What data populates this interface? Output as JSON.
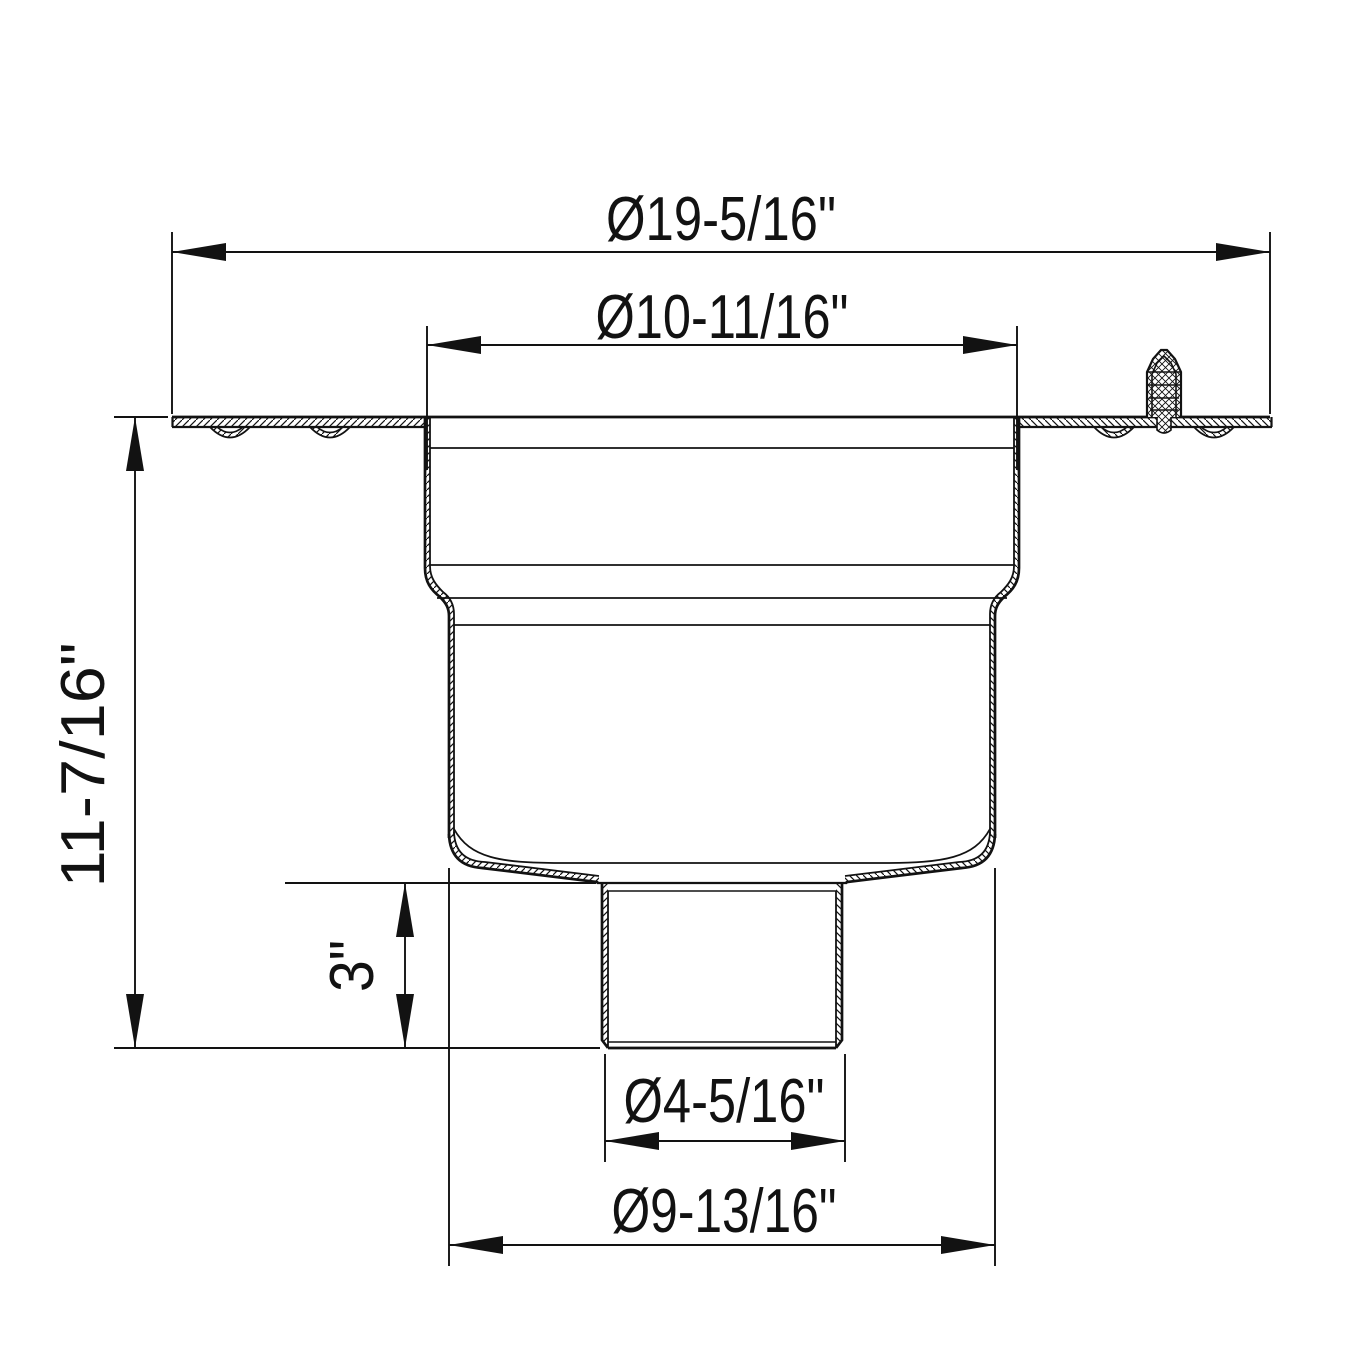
{
  "drawing": {
    "kind": "technical-section-drawing",
    "subject": "Floor drain body - sectional elevation with dimensions",
    "units": "inches",
    "line_color": "#121212",
    "background_color": "#ffffff",
    "dimensions": {
      "flange_diameter": "Ø19-5/16\"",
      "top_opening_diameter": "Ø10-11/16\"",
      "overall_height": "11-7/16\"",
      "outlet_stub_length": "3\"",
      "outlet_diameter": "Ø4-5/16\"",
      "sump_diameter": "Ø9-13/16\""
    }
  }
}
